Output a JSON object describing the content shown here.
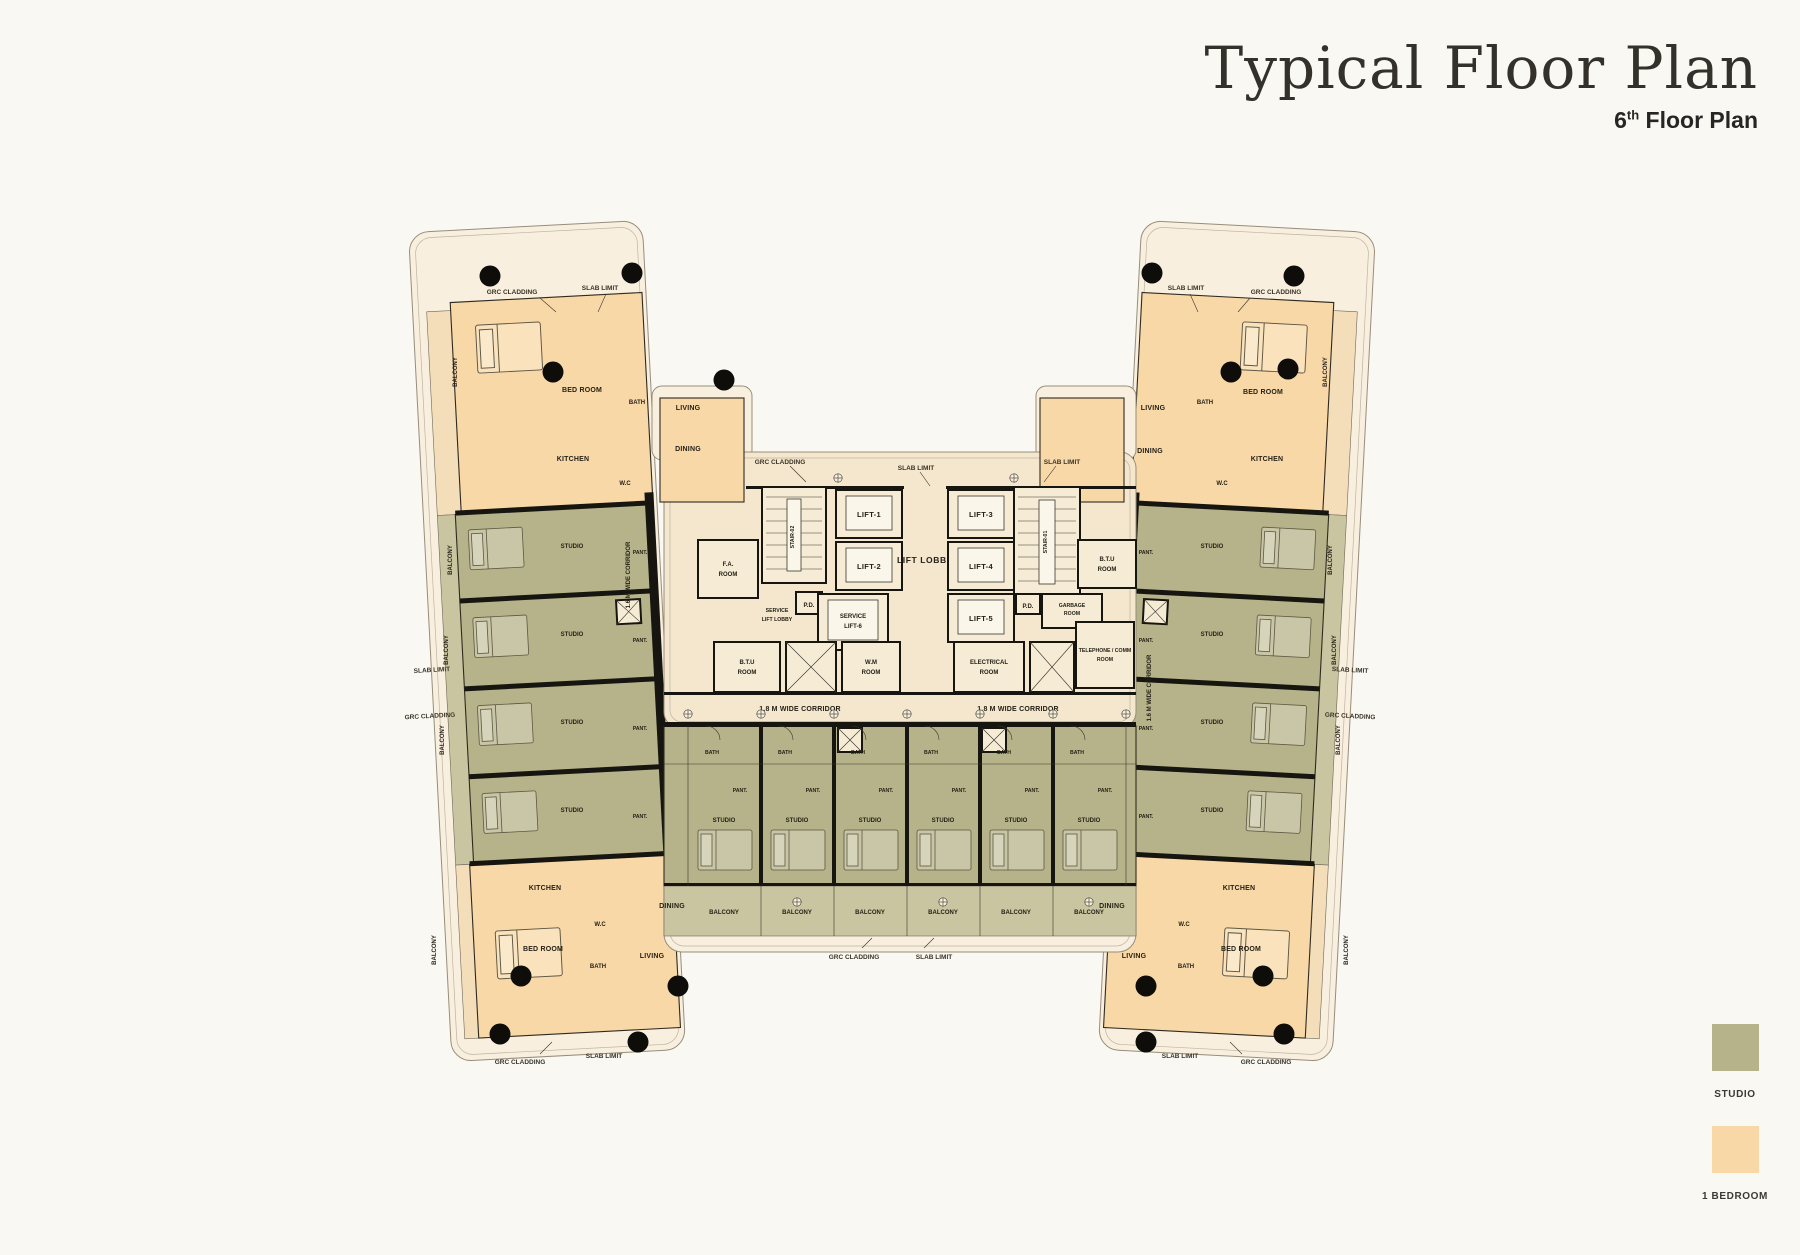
{
  "header": {
    "title": "Typical Floor Plan",
    "floor_number": "6",
    "floor_suffix": "th",
    "subtitle_rest": " Floor Plan"
  },
  "legend": {
    "studio_label": "STUDIO",
    "one_bedroom_label": "1 BEDROOM",
    "studio_color": "#b6b38a",
    "one_bedroom_color": "#f9d8a8"
  },
  "core": {
    "lift_lobby": "LIFT LOBBY",
    "lift_1": "LIFT-1",
    "lift_2": "LIFT-2",
    "lift_3": "LIFT-3",
    "lift_4": "LIFT-4",
    "lift_5": "LIFT-5",
    "service_lift_6_l1": "SERVICE",
    "service_lift_6_l2": "LIFT-6",
    "service_lift_lobby_l1": "SERVICE",
    "service_lift_lobby_l2": "LIFT LOBBY",
    "stair_01": "STAIR-01",
    "stair_02": "STAIR-02",
    "fa_room_l1": "F.A.",
    "fa_room_l2": "ROOM",
    "btu_room_l1": "B.T.U",
    "btu_room_l2": "ROOM",
    "wm_room_l1": "W.M",
    "wm_room_l2": "ROOM",
    "electrical_room_l1": "ELECTRICAL",
    "electrical_room_l2": "ROOM",
    "telephone_room_l1": "TELEPHONE / COMM",
    "telephone_room_l2": "ROOM",
    "garbage_room_l1": "GARBAGE",
    "garbage_room_l2": "ROOM",
    "pd": "P.D.",
    "corridor_18": "1.8 M WIDE CORRIDOR",
    "corridor_16": "1.6 M WIDE CORRIDOR"
  },
  "rooms": {
    "bed_room": "BED ROOM",
    "living": "LIVING",
    "dining": "DINING",
    "kitchen": "KITCHEN",
    "bath": "BATH",
    "wc": "W.C",
    "balcony": "BALCONY",
    "studio": "STUDIO",
    "pantry": "PANT."
  },
  "annotations": {
    "grc_cladding": "GRC CLADDING",
    "slab_limit": "SLAB LIMIT"
  }
}
